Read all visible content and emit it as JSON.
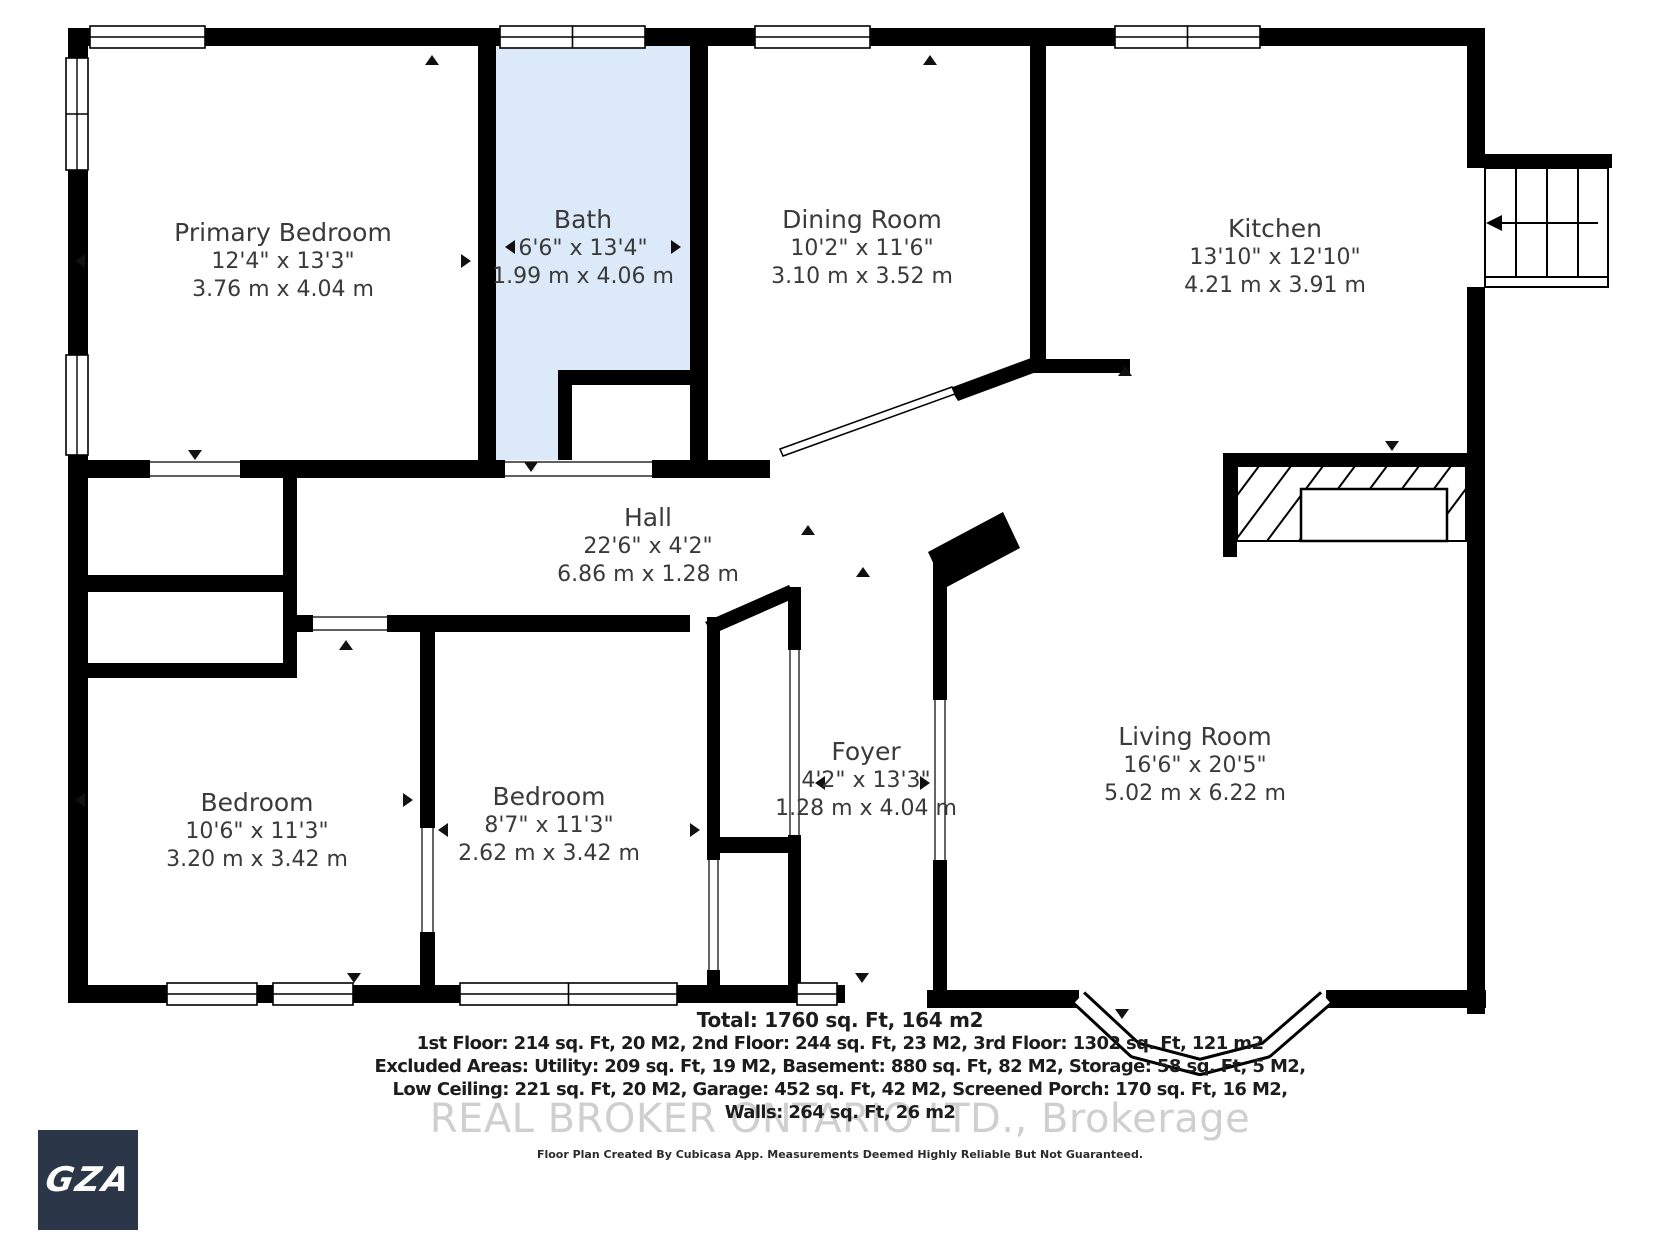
{
  "floor_plan": {
    "rooms": [
      {
        "name": "Primary Bedroom",
        "dims_ft": "12'4\" x 13'3\"",
        "dims_m": "3.76 m x 4.04 m"
      },
      {
        "name": "Bath",
        "dims_ft": "6'6\" x 13'4\"",
        "dims_m": "1.99 m x 4.06 m"
      },
      {
        "name": "Dining Room",
        "dims_ft": "10'2\" x 11'6\"",
        "dims_m": "3.10 m x 3.52 m"
      },
      {
        "name": "Kitchen",
        "dims_ft": "13'10\" x 12'10\"",
        "dims_m": "4.21 m x 3.91 m"
      },
      {
        "name": "Hall",
        "dims_ft": "22'6\" x 4'2\"",
        "dims_m": "6.86 m x 1.28 m"
      },
      {
        "name": "Foyer",
        "dims_ft": "4'2\" x 13'3\"",
        "dims_m": "1.28 m x 4.04 m"
      },
      {
        "name": "Living Room",
        "dims_ft": "16'6\" x 20'5\"",
        "dims_m": "5.02 m x 6.22 m"
      },
      {
        "name": "Bedroom",
        "dims_ft": "10'6\" x 11'3\"",
        "dims_m": "3.20 m x 3.42 m"
      },
      {
        "name": "Bedroom",
        "dims_ft": "8'7\" x 11'3\"",
        "dims_m": "2.62 m x 3.42 m"
      }
    ],
    "summary": {
      "total": "Total: 1760 sq. Ft, 164 m2",
      "line1": "1st Floor: 214 sq. Ft, 20 M2, 2nd Floor: 244 sq. Ft, 23 M2, 3rd Floor: 1302 sq. Ft, 121 m2",
      "line2": "Excluded Areas: Utility: 209 sq. Ft, 19 M2, Basement: 880 sq. Ft, 82 M2, Storage: 58 sq. Ft, 5 M2,",
      "line3": "Low Ceiling: 221 sq. Ft, 20 M2, Garage: 452 sq. Ft, 42 M2, Screened Porch: 170 sq. Ft, 16 M2,",
      "line4": "Walls: 264 sq. Ft, 26 m2"
    },
    "watermark": "REAL BROKER ONTARIO LTD.,  Brokerage",
    "disclaimer": "Floor Plan Created By Cubicasa App. Measurements Deemed Highly Reliable But Not Guaranteed.",
    "logo_text": "GZA",
    "icons": {
      "stairs": "stairs-icon",
      "fireplace": "fireplace-icon",
      "bay_window": "bay-window-icon",
      "window": "window-icon",
      "door_arrow": "door-arrow-icon"
    },
    "colors": {
      "wall": "#000000",
      "bath_fill": "#dbe9f8",
      "watermark": "#c7c7c7",
      "logo_bg": "#2b3649"
    }
  }
}
